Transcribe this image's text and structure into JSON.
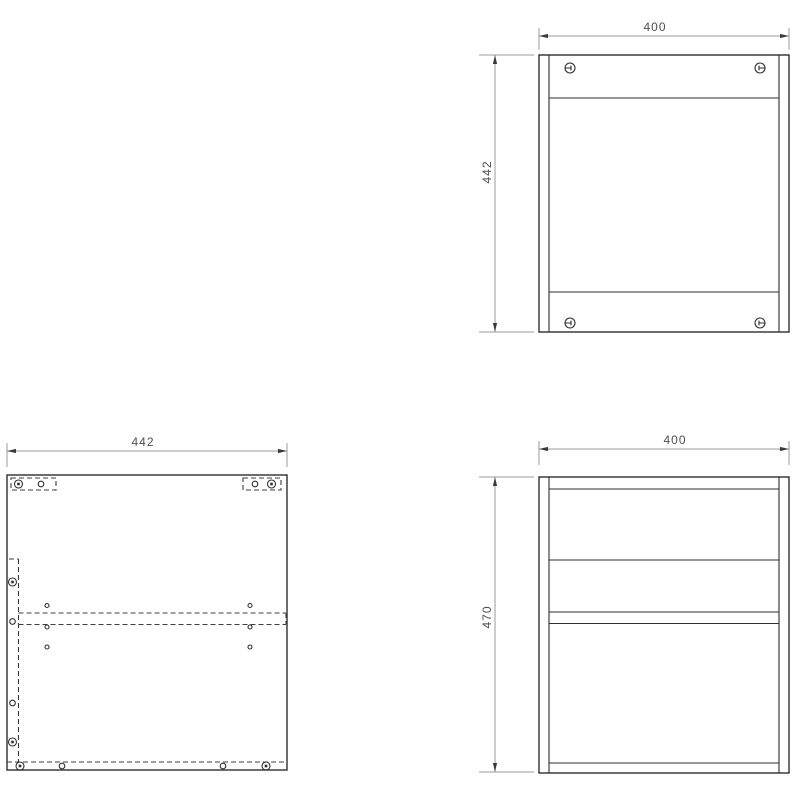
{
  "drawing": {
    "type": "furniture assembly technical drawing, three orthographic views",
    "background": "#ffffff",
    "colors": {
      "outline": "#2f2f2f",
      "hidden_line": "#3f3f3f",
      "dimension_line": "#9b9b9b",
      "dimension_text": "#4f4f4f"
    },
    "views": {
      "top_view": {
        "width_dim": "400",
        "depth_dim": "442"
      },
      "side_view": {
        "depth_dim": "442"
      },
      "front_view": {
        "width_dim": "400",
        "height_dim": "470"
      }
    }
  }
}
